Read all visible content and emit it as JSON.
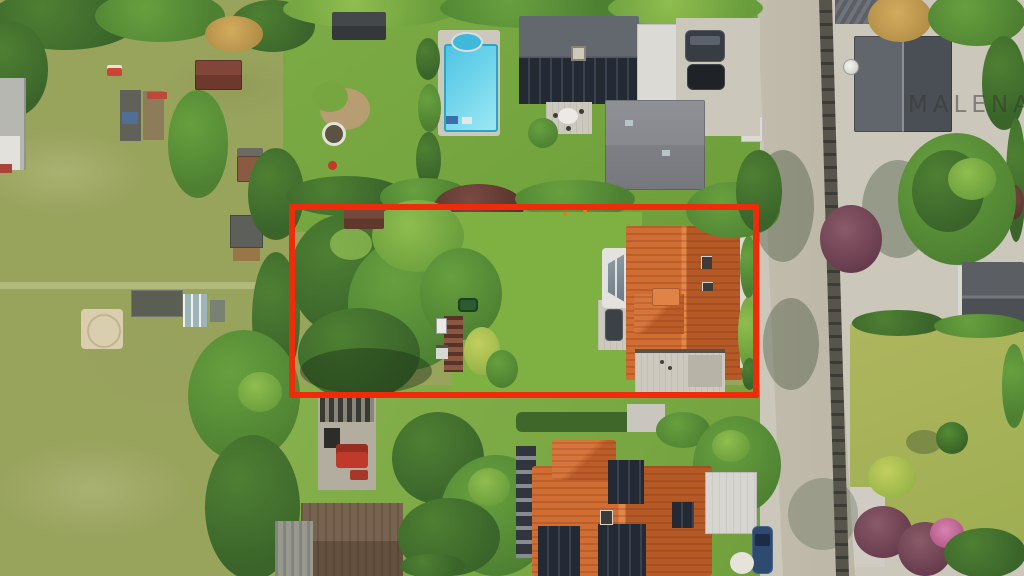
{
  "scene": {
    "type": "aerial-drone-photograph",
    "description": "Top-down drone photo of a suburban neighbourhood; a red rectangle annotation outlines a building plot with trees and an orange tile-roof house beside a road",
    "watermark": "MALENART"
  },
  "annotation": {
    "plot_outline_color": "#ee2c0c"
  },
  "palette": {
    "field": "#98a35c",
    "lawnTop": "#79aa43",
    "lawnBottom": "#82ad49",
    "lawnRight": "#a8b158",
    "road": "#c2bcae",
    "gravel": "#cbc7bb",
    "fence": "#4a4742",
    "treeDark": "#3f6b2a",
    "treeMid": "#578d36",
    "treeLight": "#8cbb4f",
    "roofOrange": "#c9632d",
    "roofDarkGray": "#565a61",
    "roofGray": "#808288",
    "solarPanel": "#252b33",
    "pool": "#4ec4e4",
    "poolDeck": "#cbc8bb",
    "whiteBuilding": "#dadad6",
    "barnRoof": "#6b5a4a",
    "redLine": "#ee2c0c"
  }
}
